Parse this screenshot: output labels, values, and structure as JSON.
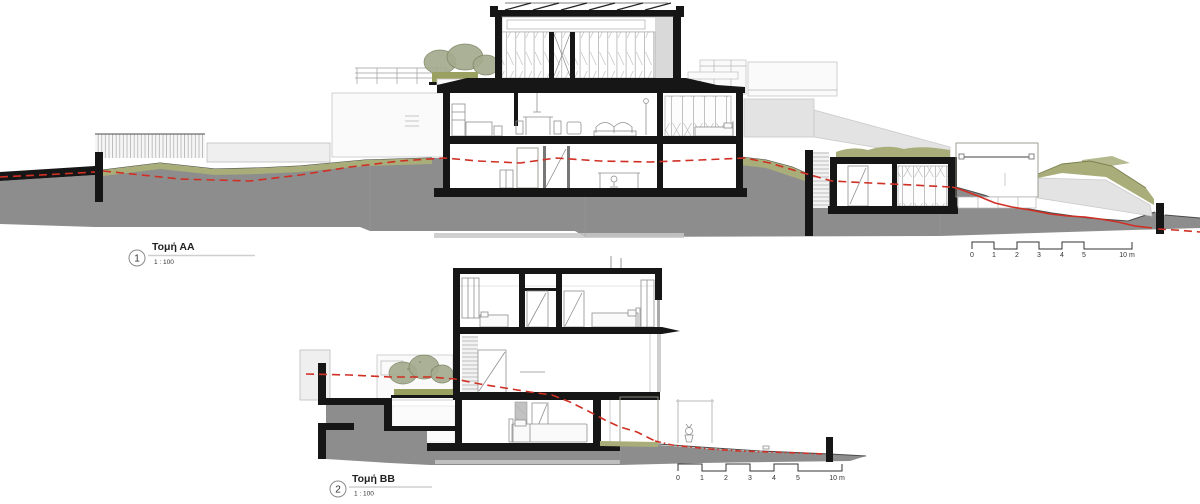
{
  "document": {
    "type": "architectural-section-drawing",
    "views": [
      {
        "number": "1",
        "title": "Τομή ΑΑ",
        "scale": "1 : 100"
      },
      {
        "number": "2",
        "title": "Τομή ΒΒ",
        "scale": "1 : 100"
      }
    ],
    "scalebar": {
      "ticks": [
        "0",
        "1",
        "2",
        "3",
        "4",
        "5"
      ],
      "end_label": "10 m"
    }
  },
  "colors": {
    "paper": "#ffffff",
    "ground_poche": "#8d8d8d",
    "vegetation": "#a8ad7a",
    "section_cut_black": "#161616",
    "grade_line_red": "#d02f24",
    "background_volume": "#efefef"
  }
}
